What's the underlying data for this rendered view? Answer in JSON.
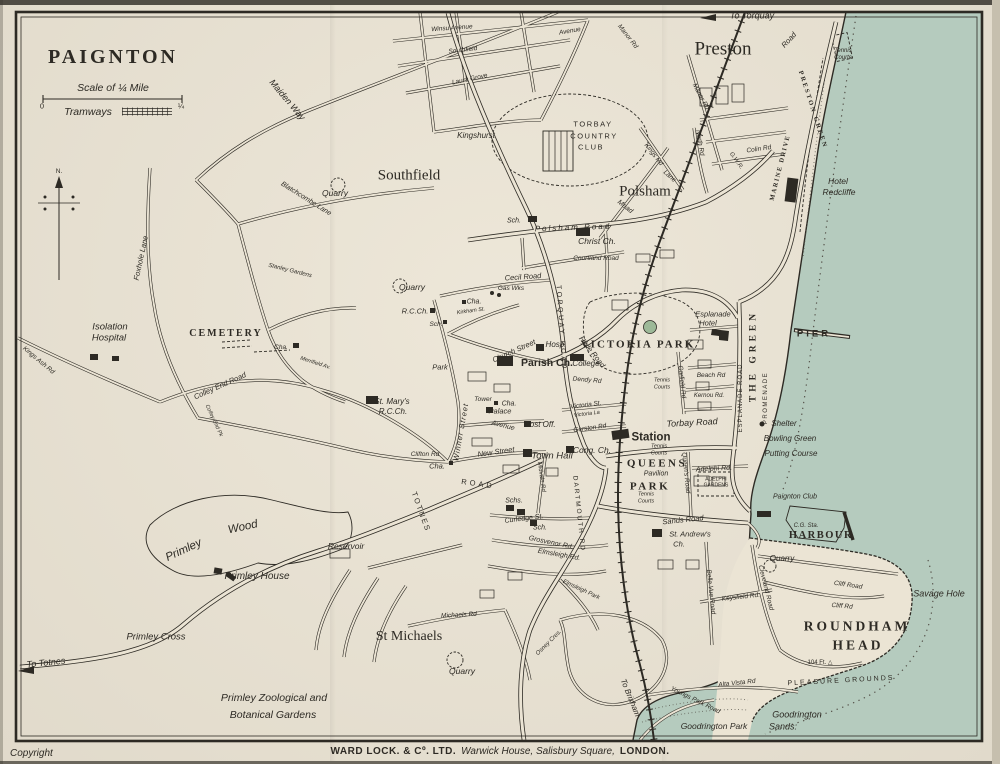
{
  "colors": {
    "paper": "#ebe4d4",
    "sea": "#b5cbbe",
    "ink": "#2d2a24",
    "park_green": "#9db998",
    "water_line": "#55524a"
  },
  "imprint": {
    "copyright": "Copyright",
    "publisher": "WARD LOCK. & Cº. LTD.",
    "address": "Warwick House, Salisbury Square,",
    "city": "LONDON."
  },
  "map": {
    "labels": [
      {
        "t": "PAIGNTON",
        "x": 113,
        "y": 57,
        "s": 20,
        "k": "cap",
        "ls": 3
      },
      {
        "t": "Scale of ¼ Mile",
        "x": 113,
        "y": 88,
        "s": 10.5
      },
      {
        "t": "0",
        "x": 42,
        "y": 106,
        "s": 7.5,
        "k": "stu"
      },
      {
        "t": "¼",
        "x": 181,
        "y": 106,
        "s": 7.5,
        "k": "stu"
      },
      {
        "t": "Tramways",
        "x": 88,
        "y": 112,
        "s": 10.5
      },
      {
        "t": "N.",
        "x": 59,
        "y": 172,
        "s": 6.5,
        "k": "stu"
      },
      {
        "t": "To Torquay",
        "x": 752,
        "y": 16,
        "s": 9
      },
      {
        "t": "Preston",
        "x": 723,
        "y": 49,
        "s": 19,
        "k": "pl"
      },
      {
        "t": "Tennis",
        "x": 843,
        "y": 51,
        "s": 6
      },
      {
        "t": "Courts",
        "x": 843,
        "y": 58,
        "s": 6
      },
      {
        "t": "PRESTON GREEN",
        "x": 812,
        "y": 110,
        "s": 6.5,
        "r": 72,
        "k": "cap",
        "ls": 2
      },
      {
        "t": "MARINE DRIVE",
        "x": 781,
        "y": 168,
        "s": 6.5,
        "r": -76,
        "k": "cap",
        "ls": 1.5
      },
      {
        "t": "Road",
        "x": 789,
        "y": 40,
        "s": 7.5,
        "r": -48
      },
      {
        "t": "Manor Rd",
        "x": 627,
        "y": 37,
        "s": 6.5,
        "r": 52
      },
      {
        "t": "Manor Rd",
        "x": 700,
        "y": 97,
        "s": 6.5,
        "r": 62
      },
      {
        "t": "Hotel",
        "x": 838,
        "y": 181,
        "s": 8.5
      },
      {
        "t": "Redcliffe",
        "x": 839,
        "y": 192,
        "s": 8.5
      },
      {
        "t": "Winsu Avenue",
        "x": 452,
        "y": 29,
        "s": 6.5,
        "r": -4
      },
      {
        "t": "Southfield",
        "x": 463,
        "y": 51,
        "s": 6.5,
        "r": -7
      },
      {
        "t": "Avenue",
        "x": 570,
        "y": 32,
        "s": 6.5,
        "r": -10
      },
      {
        "t": "Laura Grove",
        "x": 470,
        "y": 80,
        "s": 6.5,
        "r": -12
      },
      {
        "t": "Kingshurst",
        "x": 476,
        "y": 136,
        "s": 8
      },
      {
        "t": "TORBAY",
        "x": 593,
        "y": 124,
        "s": 7.5,
        "k": "sp",
        "ls": 1.5
      },
      {
        "t": "COUNTRY",
        "x": 594,
        "y": 136,
        "s": 7.5,
        "k": "sp",
        "ls": 1.5
      },
      {
        "t": "CLUB",
        "x": 591,
        "y": 147,
        "s": 7.5,
        "k": "sp",
        "ls": 1.5
      },
      {
        "t": "Southfield",
        "x": 409,
        "y": 176,
        "s": 15,
        "k": "pl"
      },
      {
        "t": "Polsham",
        "x": 645,
        "y": 192,
        "s": 15,
        "k": "pl"
      },
      {
        "t": "Maiden Way",
        "x": 287,
        "y": 100,
        "s": 9,
        "r": 50
      },
      {
        "t": "Blatchcombe Lane",
        "x": 306,
        "y": 199,
        "s": 7,
        "r": 32
      },
      {
        "t": "Quarry",
        "x": 335,
        "y": 193,
        "s": 8.5
      },
      {
        "t": "Foxhole Lane",
        "x": 141,
        "y": 258,
        "s": 7.5,
        "r": -78
      },
      {
        "t": "Kings Ash Rd",
        "x": 38,
        "y": 361,
        "s": 6.5,
        "r": 40
      },
      {
        "t": "Stanley Gardens",
        "x": 290,
        "y": 271,
        "s": 6,
        "r": 14
      },
      {
        "t": "Mead",
        "x": 625,
        "y": 207,
        "s": 7,
        "r": 38
      },
      {
        "t": "Lane",
        "x": 669,
        "y": 177,
        "s": 6.5,
        "r": 42
      },
      {
        "t": "Kings Rd",
        "x": 653,
        "y": 155,
        "s": 6.5,
        "r": 52
      },
      {
        "t": "North Rd",
        "x": 699,
        "y": 143,
        "s": 6.5,
        "r": 80
      },
      {
        "t": "Colin Rd",
        "x": 759,
        "y": 150,
        "s": 6.5,
        "r": -8
      },
      {
        "t": "G.W.R.",
        "x": 736,
        "y": 161,
        "s": 6,
        "r": 55
      },
      {
        "t": "Polsham Road",
        "x": 573,
        "y": 228,
        "s": 8,
        "ls": 2,
        "r": -2
      },
      {
        "t": "Sch.",
        "x": 514,
        "y": 221,
        "s": 7
      },
      {
        "t": "Christ Ch.",
        "x": 597,
        "y": 241,
        "s": 8.5
      },
      {
        "t": "Courtland Road",
        "x": 596,
        "y": 259,
        "s": 6.5
      },
      {
        "t": "Cecil Road",
        "x": 523,
        "y": 277,
        "s": 7.5,
        "r": -4
      },
      {
        "t": "Gas Wks",
        "x": 511,
        "y": 289,
        "s": 6.5
      },
      {
        "t": "Quarry",
        "x": 412,
        "y": 287,
        "s": 8.5
      },
      {
        "t": "R.C.Ch.",
        "x": 415,
        "y": 311,
        "s": 7.5
      },
      {
        "t": "Sch.",
        "x": 436,
        "y": 325,
        "s": 6.5
      },
      {
        "t": "Cha.",
        "x": 474,
        "y": 302,
        "s": 7
      },
      {
        "t": "Kirkham St.",
        "x": 471,
        "y": 312,
        "s": 5.5,
        "r": -8
      },
      {
        "t": "CEMETERY",
        "x": 226,
        "y": 334,
        "s": 10,
        "k": "cap",
        "ls": 2
      },
      {
        "t": "Cha.",
        "x": 281,
        "y": 348,
        "s": 6.5
      },
      {
        "t": "Isolation",
        "x": 110,
        "y": 327,
        "s": 9.5
      },
      {
        "t": "Hospital",
        "x": 109,
        "y": 338,
        "s": 9.5
      },
      {
        "t": "Colley End Road",
        "x": 220,
        "y": 386,
        "s": 7.5,
        "r": -24
      },
      {
        "t": "Colley End Pk",
        "x": 213,
        "y": 421,
        "s": 5.5,
        "r": 65
      },
      {
        "t": "Merrifield Av.",
        "x": 315,
        "y": 364,
        "s": 5.5,
        "r": 18
      },
      {
        "t": "Park",
        "x": 440,
        "y": 367,
        "s": 7.5
      },
      {
        "t": "St. Mary's",
        "x": 392,
        "y": 402,
        "s": 8
      },
      {
        "t": "R.C.Ch.",
        "x": 393,
        "y": 412,
        "s": 8
      },
      {
        "t": "TORQUAY ROAD",
        "x": 561,
        "y": 328,
        "s": 7,
        "r": 86,
        "k": "sp",
        "ls": 2.5
      },
      {
        "t": "Church Street",
        "x": 514,
        "y": 351,
        "s": 7.5,
        "r": -24
      },
      {
        "t": "Winner Street",
        "x": 461,
        "y": 432,
        "s": 7.5,
        "r": -80,
        "ls": 1
      },
      {
        "t": "Hyde Road",
        "x": 592,
        "y": 352,
        "s": 7.5,
        "r": 52
      },
      {
        "t": "Hosp.",
        "x": 556,
        "y": 345,
        "s": 8
      },
      {
        "t": "Parish Ch.",
        "x": 547,
        "y": 363,
        "s": 10.5,
        "k": "b"
      },
      {
        "t": "College",
        "x": 586,
        "y": 364,
        "s": 8
      },
      {
        "t": "Dendy Rd",
        "x": 587,
        "y": 381,
        "s": 6.5,
        "r": 5
      },
      {
        "t": "VICTORIA PARK",
        "x": 638,
        "y": 345,
        "s": 11,
        "k": "cap",
        "ls": 2
      },
      {
        "t": "Tennis",
        "x": 662,
        "y": 381,
        "s": 5.5
      },
      {
        "t": "Courts",
        "x": 662,
        "y": 388,
        "s": 5.5
      },
      {
        "t": "Victoria St.",
        "x": 586,
        "y": 406,
        "s": 6.5,
        "r": -7
      },
      {
        "t": "Victoria La",
        "x": 587,
        "y": 415,
        "s": 5.5,
        "r": -7
      },
      {
        "t": "Gerston Rd",
        "x": 590,
        "y": 429,
        "s": 6.5,
        "r": -8
      },
      {
        "t": "Tower",
        "x": 483,
        "y": 400,
        "s": 6.5
      },
      {
        "t": "Cha.",
        "x": 509,
        "y": 404,
        "s": 7
      },
      {
        "t": "Palace",
        "x": 500,
        "y": 411,
        "s": 7.5
      },
      {
        "t": "Avenue",
        "x": 503,
        "y": 426,
        "s": 7,
        "r": 14
      },
      {
        "t": "Post Off.",
        "x": 540,
        "y": 425,
        "s": 8
      },
      {
        "t": "New Street",
        "x": 496,
        "y": 452,
        "s": 7.5,
        "r": -8
      },
      {
        "t": "Town Hall",
        "x": 552,
        "y": 456,
        "s": 9.5
      },
      {
        "t": "Cong. Ch.",
        "x": 592,
        "y": 450,
        "s": 8.5
      },
      {
        "t": "Clifton Rd",
        "x": 425,
        "y": 455,
        "s": 6.5
      },
      {
        "t": "Cha.",
        "x": 437,
        "y": 466,
        "s": 7.5
      },
      {
        "t": "Station",
        "x": 651,
        "y": 438,
        "s": 11.5,
        "k": "b"
      },
      {
        "t": "Tennis",
        "x": 659,
        "y": 447,
        "s": 5.5
      },
      {
        "t": "Courts",
        "x": 659,
        "y": 454,
        "s": 5.5
      },
      {
        "t": "Torbay Road",
        "x": 692,
        "y": 423,
        "s": 9,
        "r": -3
      },
      {
        "t": "QUEENS",
        "x": 657,
        "y": 464,
        "s": 11,
        "k": "cap",
        "ls": 2.5
      },
      {
        "t": "Pavilion",
        "x": 656,
        "y": 474,
        "s": 7
      },
      {
        "t": "PARK",
        "x": 650,
        "y": 487,
        "s": 11,
        "k": "cap",
        "ls": 2.5
      },
      {
        "t": "Tennis",
        "x": 646,
        "y": 495,
        "s": 5.5
      },
      {
        "t": "Courts",
        "x": 646,
        "y": 502,
        "s": 5.5
      },
      {
        "t": "Adelphi Rd.",
        "x": 714,
        "y": 469,
        "s": 7,
        "r": -3
      },
      {
        "t": "ADELPHI",
        "x": 716,
        "y": 480,
        "s": 5,
        "k": "sp"
      },
      {
        "t": "GARDENS",
        "x": 716,
        "y": 486,
        "s": 5,
        "k": "sp"
      },
      {
        "t": "Queen's Road",
        "x": 685,
        "y": 473,
        "s": 6.5,
        "r": 84
      },
      {
        "t": "Garfield Rd",
        "x": 681,
        "y": 382,
        "s": 6.5,
        "r": 84
      },
      {
        "t": "Beach Rd",
        "x": 711,
        "y": 376,
        "s": 6.5
      },
      {
        "t": "Kernou Rd.",
        "x": 709,
        "y": 396,
        "s": 6
      },
      {
        "t": "Esplanade",
        "x": 713,
        "y": 314,
        "s": 7.5
      },
      {
        "t": "Hotel",
        "x": 708,
        "y": 323,
        "s": 7.5
      },
      {
        "t": "ESPLANADE ROAD",
        "x": 741,
        "y": 398,
        "s": 6,
        "r": -90,
        "k": "sp",
        "ls": 1
      },
      {
        "t": "PROMENADE",
        "x": 766,
        "y": 398,
        "s": 6,
        "r": -90,
        "k": "sp",
        "ls": 1.5
      },
      {
        "t": "THE GREEN",
        "x": 754,
        "y": 356,
        "s": 9.5,
        "r": -90,
        "k": "cap",
        "ls": 4
      },
      {
        "t": "PIER",
        "x": 814,
        "y": 334,
        "s": 9.5,
        "k": "b",
        "ls": 3
      },
      {
        "t": "Shelter",
        "x": 784,
        "y": 424,
        "s": 8
      },
      {
        "t": "Bowling Green",
        "x": 790,
        "y": 439,
        "s": 8
      },
      {
        "t": "Putting Course",
        "x": 791,
        "y": 454,
        "s": 8
      },
      {
        "t": "Sands Road",
        "x": 683,
        "y": 520,
        "s": 7.5,
        "r": -6
      },
      {
        "t": "St. Andrew's",
        "x": 690,
        "y": 534,
        "s": 7.5
      },
      {
        "t": "Ch.",
        "x": 679,
        "y": 544,
        "s": 7.5
      },
      {
        "t": "DARTMOUTH RD",
        "x": 578,
        "y": 514,
        "s": 6.5,
        "r": 84,
        "k": "sp",
        "ls": 2
      },
      {
        "t": "Midvale Rd",
        "x": 541,
        "y": 477,
        "s": 6,
        "r": 82
      },
      {
        "t": "Curledge St.",
        "x": 524,
        "y": 519,
        "s": 7,
        "r": -7
      },
      {
        "t": "Schs.",
        "x": 514,
        "y": 501,
        "s": 7
      },
      {
        "t": "Sch.",
        "x": 540,
        "y": 528,
        "s": 7
      },
      {
        "t": "Grosvenor Rd.",
        "x": 551,
        "y": 543,
        "s": 7,
        "r": 12
      },
      {
        "t": "Elmsleigh Rd.",
        "x": 559,
        "y": 555,
        "s": 7,
        "r": 10
      },
      {
        "t": "Elmsleigh Park",
        "x": 581,
        "y": 590,
        "s": 6,
        "r": 25
      },
      {
        "t": "TOTNES",
        "x": 421,
        "y": 512,
        "s": 7.5,
        "r": 70,
        "k": "sp",
        "ls": 2
      },
      {
        "t": "ROAD",
        "x": 478,
        "y": 484,
        "s": 7.5,
        "r": 8,
        "k": "sp",
        "ls": 3
      },
      {
        "t": "St Michaels",
        "x": 409,
        "y": 637,
        "s": 14,
        "k": "pl"
      },
      {
        "t": "Michaels Rd",
        "x": 459,
        "y": 616,
        "s": 6.5,
        "r": -3
      },
      {
        "t": "Quarry",
        "x": 462,
        "y": 671,
        "s": 8.5
      },
      {
        "t": "Osney Cres.",
        "x": 549,
        "y": 643,
        "s": 6,
        "r": -45
      },
      {
        "t": "To Brixham",
        "x": 630,
        "y": 698,
        "s": 8,
        "r": 68
      },
      {
        "t": "Primley",
        "x": 184,
        "y": 551,
        "s": 11.5,
        "r": -25
      },
      {
        "t": "Wood",
        "x": 243,
        "y": 528,
        "s": 11.5,
        "r": -12
      },
      {
        "t": "Reservoir",
        "x": 346,
        "y": 546,
        "s": 8.5
      },
      {
        "t": "Primley House",
        "x": 257,
        "y": 577,
        "s": 10
      },
      {
        "t": "Primley Cross",
        "x": 156,
        "y": 637,
        "s": 9.5
      },
      {
        "t": "To Totnes",
        "x": 46,
        "y": 663,
        "s": 9,
        "r": -6
      },
      {
        "t": "Primley Zoological and",
        "x": 274,
        "y": 698,
        "s": 10.5
      },
      {
        "t": "Botanical Gardens",
        "x": 273,
        "y": 715,
        "s": 10.5
      },
      {
        "t": "Goodrington Park",
        "x": 714,
        "y": 726,
        "s": 8.5
      },
      {
        "t": "Goodrington",
        "x": 797,
        "y": 715,
        "s": 9
      },
      {
        "t": "Sands:",
        "x": 783,
        "y": 727,
        "s": 9
      },
      {
        "t": "Youngs Park Road",
        "x": 695,
        "y": 701,
        "s": 6.5,
        "r": 26
      },
      {
        "t": "Alta Vista Rd",
        "x": 737,
        "y": 684,
        "s": 6.5,
        "r": -6
      },
      {
        "t": "PLEASURE GROUNDS",
        "x": 841,
        "y": 681,
        "s": 7,
        "r": -3,
        "k": "sp",
        "ls": 2
      },
      {
        "t": "ROUNDHAM",
        "x": 857,
        "y": 626,
        "s": 13.5,
        "k": "cap",
        "ls": 3
      },
      {
        "t": "HEAD",
        "x": 858,
        "y": 645,
        "s": 13.5,
        "k": "cap",
        "ls": 3
      },
      {
        "t": "104 Ft. △",
        "x": 820,
        "y": 663,
        "s": 6,
        "k": "stu"
      },
      {
        "t": "Savage Hole",
        "x": 939,
        "y": 594,
        "s": 9
      },
      {
        "t": "Cliff Road",
        "x": 848,
        "y": 586,
        "s": 6.5,
        "r": 8
      },
      {
        "t": "Cliff Rd",
        "x": 842,
        "y": 607,
        "s": 6.5,
        "r": 5
      },
      {
        "t": "Keysfield Rd.",
        "x": 741,
        "y": 598,
        "s": 6.5,
        "r": -6
      },
      {
        "t": "Belle Vue Road",
        "x": 710,
        "y": 592,
        "s": 6.5,
        "r": 84
      },
      {
        "t": "Cleveland Road",
        "x": 765,
        "y": 588,
        "s": 6.5,
        "r": 76
      },
      {
        "t": "HARBOUR",
        "x": 821,
        "y": 536,
        "s": 10.5,
        "k": "cap",
        "ls": 1.5
      },
      {
        "t": "C.G. Sta.",
        "x": 806,
        "y": 526,
        "s": 6
      },
      {
        "t": "Paignton Club",
        "x": 795,
        "y": 497,
        "s": 7
      },
      {
        "t": "Quarry",
        "x": 782,
        "y": 559,
        "s": 8
      }
    ]
  }
}
